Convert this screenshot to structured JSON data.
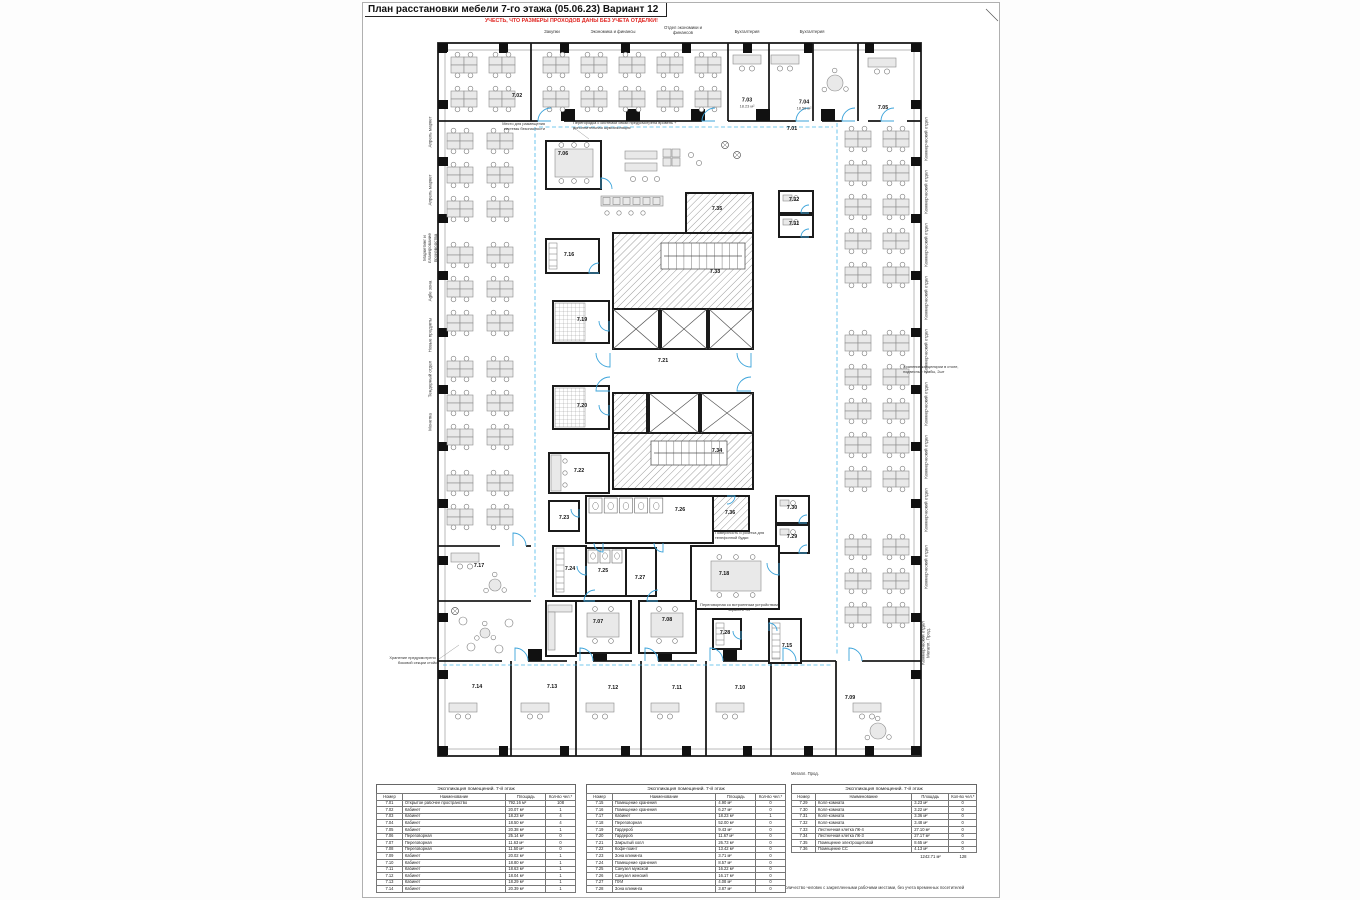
{
  "sheet": {
    "title": "План расстановки мебели 7-го этажа (05.06.23) Вариант 12",
    "warning": "УЧЕСТЬ, ЧТО РАЗМЕРЫ ПРОХОДОВ ДАНЫ БЕЗ УЧЕТА ОТДЕЛКИ!",
    "footnote": "*Указано количество человек с закрепленными рабочими местами, без учета временных посетителей"
  },
  "top_labels": [
    {
      "text": "Закупки",
      "x": 189,
      "y": 26
    },
    {
      "text": "Экономика и финансы",
      "x": 250,
      "y": 26
    },
    {
      "text": "Отдел экономики и\nфинансов",
      "x": 320,
      "y": 22
    },
    {
      "text": "Бухгалтерия",
      "x": 384,
      "y": 26
    },
    {
      "text": "Бухгалтерия",
      "x": 449,
      "y": 26
    }
  ],
  "left_labels": [
    {
      "text": "Апрель маркет",
      "y": 129
    },
    {
      "text": "Апрель маркет",
      "y": 187
    },
    {
      "text": "Маркетинг и\nпланирование\nпроизводства",
      "y": 245
    },
    {
      "text": "Agile зона",
      "y": 288
    },
    {
      "text": "Новые продукты",
      "y": 332
    },
    {
      "text": "Тендерный отдел",
      "y": 376
    },
    {
      "text": "Монетка",
      "y": 419
    }
  ],
  "right_labels": [
    {
      "text": "Коммерческий отдел",
      "y": 136
    },
    {
      "text": "Коммерческий отдел",
      "y": 189
    },
    {
      "text": "Коммерческий отдел",
      "y": 242
    },
    {
      "text": "Коммерческий отдел",
      "y": 295
    },
    {
      "text": "Коммерческий отдел",
      "y": 348
    },
    {
      "text": "Коммерческий отдел",
      "y": 401
    },
    {
      "text": "Коммерческий отдел",
      "y": 454
    },
    {
      "text": "Коммерческий отдел",
      "y": 507
    },
    {
      "text": "Коммерческий отдел",
      "y": 564
    },
    {
      "text": "Коммерческий отдел\nМегапл. Прод.",
      "y": 640
    }
  ],
  "misc_labels": [
    {
      "text": "Мегапл. Прод.",
      "x": 428,
      "y": 768
    }
  ],
  "annotations": [
    {
      "text": "Место для размещения\nсистемы безопасности",
      "x": 124,
      "y": 119,
      "w": 58,
      "align": "right"
    },
    {
      "text": "Перегородка с системой связи предусмотрена вровень +\nдополнительная шумоизоляция",
      "x": 210,
      "y": 118,
      "w": 122,
      "align": "left"
    },
    {
      "text": "Хранение канцелярии в столе,\nподвесные тумбы, 2шт",
      "x": 540,
      "y": 362,
      "w": 82,
      "align": "left"
    },
    {
      "text": "Хранение предусмотрено в\nбоковой секции стойки",
      "x": 12,
      "y": 653,
      "w": 64,
      "align": "right"
    },
    {
      "text": "Поверхность и розетка для\nтелефонной будки",
      "x": 352,
      "y": 528,
      "w": 58,
      "align": "left"
    },
    {
      "text": "Переговорная со встроенным устройством\nэкрана и ТВ",
      "x": 336,
      "y": 600,
      "w": 80,
      "align": "center"
    }
  ],
  "rooms": [
    {
      "n": "7.02",
      "x": 154,
      "y": 93
    },
    {
      "n": "7.03",
      "x": 384,
      "y": 100,
      "a": "18.23 м²"
    },
    {
      "n": "7.04",
      "x": 441,
      "y": 102,
      "a": "18.50 м²"
    },
    {
      "n": "7.05",
      "x": 520,
      "y": 105
    },
    {
      "n": "7.01",
      "x": 429,
      "y": 126
    },
    {
      "n": "7.06",
      "x": 200,
      "y": 151
    },
    {
      "n": "7.35",
      "x": 354,
      "y": 206
    },
    {
      "n": "7.32",
      "x": 431,
      "y": 197
    },
    {
      "n": "7.31",
      "x": 431,
      "y": 221
    },
    {
      "n": "7.16",
      "x": 206,
      "y": 252
    },
    {
      "n": "7.33",
      "x": 352,
      "y": 269
    },
    {
      "n": "7.19",
      "x": 219,
      "y": 317
    },
    {
      "n": "7.21",
      "x": 300,
      "y": 358
    },
    {
      "n": "7.20",
      "x": 219,
      "y": 403
    },
    {
      "n": "7.34",
      "x": 354,
      "y": 448
    },
    {
      "n": "7.22",
      "x": 216,
      "y": 468
    },
    {
      "n": "7.23",
      "x": 201,
      "y": 515
    },
    {
      "n": "7.26",
      "x": 317,
      "y": 507
    },
    {
      "n": "7.36",
      "x": 367,
      "y": 510
    },
    {
      "n": "7.30",
      "x": 429,
      "y": 505
    },
    {
      "n": "7.29",
      "x": 429,
      "y": 534
    },
    {
      "n": "7.24",
      "x": 207,
      "y": 566
    },
    {
      "n": "7.25",
      "x": 240,
      "y": 568
    },
    {
      "n": "7.27",
      "x": 277,
      "y": 575
    },
    {
      "n": "7.18",
      "x": 361,
      "y": 571
    },
    {
      "n": "7.17",
      "x": 116,
      "y": 563
    },
    {
      "n": "7.07",
      "x": 235,
      "y": 619
    },
    {
      "n": "7.08",
      "x": 304,
      "y": 617
    },
    {
      "n": "7.28",
      "x": 362,
      "y": 630
    },
    {
      "n": "7.15",
      "x": 424,
      "y": 643
    },
    {
      "n": "7.14",
      "x": 114,
      "y": 684
    },
    {
      "n": "7.13",
      "x": 189,
      "y": 684
    },
    {
      "n": "7.12",
      "x": 250,
      "y": 685
    },
    {
      "n": "7.11",
      "x": 314,
      "y": 685
    },
    {
      "n": "7.10",
      "x": 377,
      "y": 685
    },
    {
      "n": "7.09",
      "x": 487,
      "y": 695
    }
  ],
  "tables": [
    {
      "title": "Экспликация помещений. 7-й этаж",
      "headers": [
        "Номер",
        "Наименование",
        "Площадь",
        "Кол-во чел.*"
      ],
      "rows": [
        [
          "7.01",
          "Открытое рабочее пространство",
          "792.16 м²",
          "108"
        ],
        [
          "7.02",
          "Кабинет",
          "20.07 м²",
          "1"
        ],
        [
          "7.03",
          "Кабинет",
          "18.23 м²",
          "4"
        ],
        [
          "7.04",
          "Кабинет",
          "18.50 м²",
          "4"
        ],
        [
          "7.05",
          "Кабинет",
          "20.38 м²",
          "1"
        ],
        [
          "7.06",
          "Переговорная",
          "25.14 м²",
          "0"
        ],
        [
          "7.07",
          "Переговорная",
          "11.63 м²",
          "0"
        ],
        [
          "7.08",
          "Переговорная",
          "11.50 м²",
          "0"
        ],
        [
          "7.09",
          "Кабинет",
          "20.02 м²",
          "1"
        ],
        [
          "7.10",
          "Кабинет",
          "18.80 м²",
          "1"
        ],
        [
          "7.11",
          "Кабинет",
          "18.63 м²",
          "1"
        ],
        [
          "7.12",
          "Кабинет",
          "18.04 м²",
          "1"
        ],
        [
          "7.13",
          "Кабинет",
          "18.29 м²",
          "1"
        ],
        [
          "7.14",
          "Кабинет",
          "20.39 м²",
          "1"
        ]
      ]
    },
    {
      "title": "Экспликация помещений. 7-й этаж",
      "headers": [
        "Номер",
        "Наименование",
        "Площадь",
        "Кол-во чел.*"
      ],
      "rows": [
        [
          "7.15",
          "Помещение хранения",
          "4.90 м²",
          "0"
        ],
        [
          "7.16",
          "Помещение хранения",
          "6.27 м²",
          "0"
        ],
        [
          "7.17",
          "Кабинет",
          "18.23 м²",
          "1"
        ],
        [
          "7.18",
          "Переговорная",
          "52.00 м²",
          "0"
        ],
        [
          "7.19",
          "Гардероб",
          "9.43 м²",
          "0"
        ],
        [
          "7.20",
          "Гардероб",
          "11.67 м²",
          "0"
        ],
        [
          "7.21",
          "Закрытый холл",
          "26.73 м²",
          "0"
        ],
        [
          "7.22",
          "Кофе-поинт",
          "13.42 м²",
          "0"
        ],
        [
          "7.23",
          "Зона клининга",
          "3.71 м²",
          "0"
        ],
        [
          "7.24",
          "Помещение хранения",
          "8.57 м²",
          "0"
        ],
        [
          "7.25",
          "Санузел мужской",
          "16.22 м²",
          "0"
        ],
        [
          "7.26",
          "Санузел женский",
          "16.17 м²",
          "0"
        ],
        [
          "7.27",
          "ПУИ",
          "4.08 м²",
          "0"
        ],
        [
          "7.28",
          "Зона клининга",
          "3.87 м²",
          "0"
        ]
      ]
    },
    {
      "title": "Экспликация помещений. 7-й этаж",
      "headers": [
        "Номер",
        "Наименование",
        "Площадь",
        "Кол-во чел.*"
      ],
      "rows": [
        [
          "7.29",
          "Колл-комната",
          "3.23 м²",
          "0"
        ],
        [
          "7.30",
          "Колл-комната",
          "3.22 м²",
          "0"
        ],
        [
          "7.31",
          "Колл-комната",
          "3.36 м²",
          "0"
        ],
        [
          "7.32",
          "Колл-комната",
          "3.48 м²",
          "0"
        ],
        [
          "7.33",
          "Лестничная клетка ЛК-4",
          "27.10 м²",
          "0"
        ],
        [
          "7.34",
          "Лестничная клетка ЛК-3",
          "27.17 м²",
          "0"
        ],
        [
          "7.35",
          "Помещение электрощитовой",
          "8.65 м²",
          "0"
        ],
        [
          "7.36",
          "Помещение СС",
          "4.13 м²",
          "0"
        ]
      ],
      "totals": [
        "1242.71 м²",
        "128"
      ]
    }
  ],
  "colors": {
    "accent_blue": "#3ba3da",
    "warning_red": "#e02420",
    "wall_black": "#1b1b1b"
  }
}
